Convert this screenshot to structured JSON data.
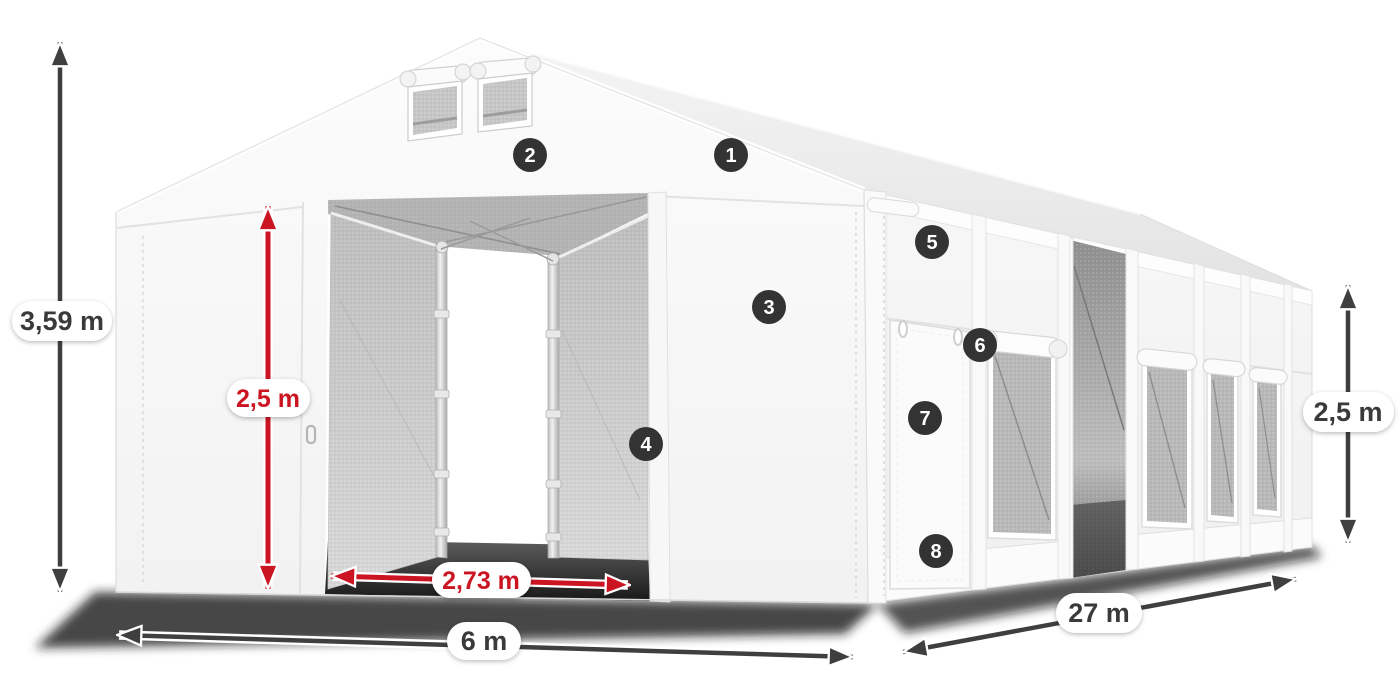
{
  "diagram": {
    "subject": "warehouse-tent-dimensions",
    "labels": {
      "total_height": "3,59 m",
      "entrance_height": "2,5 m",
      "entrance_width": "2,73 m",
      "tent_width": "6 m",
      "tent_length": "27 m",
      "side_wall_height": "2,5 m"
    },
    "callouts": [
      {
        "number": "1"
      },
      {
        "number": "2"
      },
      {
        "number": "3"
      },
      {
        "number": "4"
      },
      {
        "number": "5"
      },
      {
        "number": "6"
      },
      {
        "number": "7"
      },
      {
        "number": "8"
      }
    ],
    "colors": {
      "dimension_red": "#cc1522",
      "dimension_gray": "#3f3f3f",
      "callout_background": "#333333",
      "label_text_dark": "#3a3a3a",
      "tent_white": "#f7f7f7",
      "mesh_gray": "#b8b8b8"
    }
  }
}
